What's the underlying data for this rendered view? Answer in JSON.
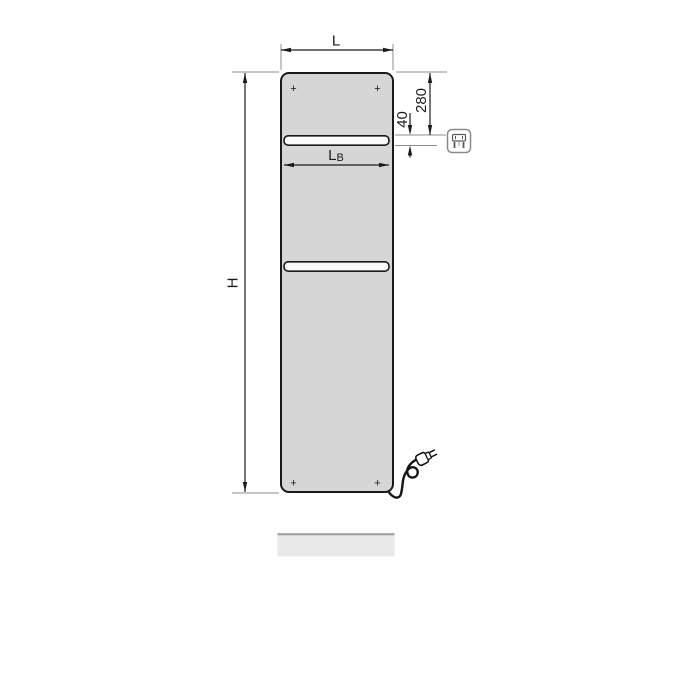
{
  "drawing": {
    "labels": {
      "width": "L",
      "height": "H",
      "bar_width_main": "L",
      "bar_width_sub": "B",
      "top_offset": "280",
      "slot_height": "40",
      "mount_marker": "+"
    },
    "colors": {
      "background": "#ffffff",
      "panel_fill": "#d6d6d6",
      "panel_stroke": "#1a1a1a",
      "slot_fill": "#fafafa",
      "dimension_line": "#1a1a1a",
      "extension_line": "#8c8c8c",
      "shadow_fill": "#e9e9e9",
      "shadow_edge": "#9c9c9c",
      "icon_stroke": "#8a8a8a",
      "cord_stroke": "#151515"
    },
    "icons": {
      "badge": "electric-plug-icon",
      "cord": "power-cord-with-plug-icon"
    }
  }
}
